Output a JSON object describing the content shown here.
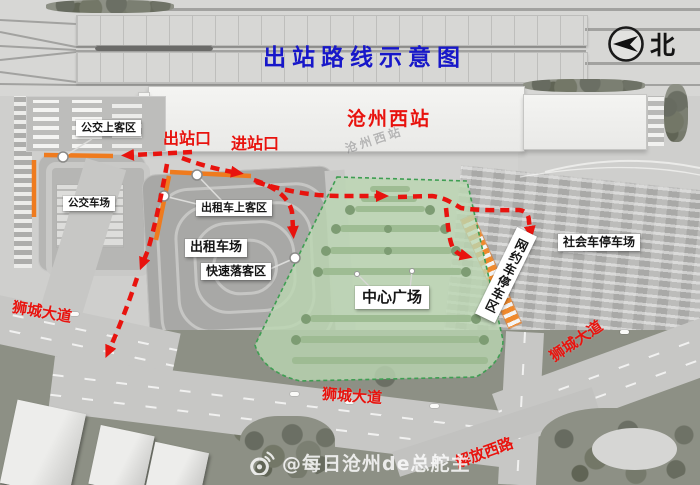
{
  "title": {
    "text": "出站路线示意图",
    "color": "#1717c9"
  },
  "compass": {
    "north_label": "北",
    "icon": "north-arrow-icon"
  },
  "station": {
    "name": "沧州西站",
    "faint_name": "沧州西站"
  },
  "gates": {
    "exit": "出站口",
    "entrance": "进站口"
  },
  "areas": {
    "bus_boarding": "公交上客区",
    "bus_yard": "公交车场",
    "taxi_boarding": "出租车上客区",
    "taxi_yard": "出租车场",
    "quick_dropoff": "快速落客区",
    "central_plaza": "中心广场",
    "ride_hailing_parking": "网约车停车区",
    "public_parking": "社会车停车场"
  },
  "roads": {
    "shicheng_avenue": "狮城大道",
    "jiefang_west_road": "解放西路"
  },
  "legend_colors": {
    "route_red": "#e8130e",
    "pickup_highlight_orange": "#ef7b1e",
    "plaza_green_fill": "#bcd8b4",
    "plaza_green_border": "#3f9e53",
    "title_blue": "#1717c9"
  },
  "watermark": {
    "icon": "weibo-icon",
    "text": "@每日沧州de总舵主"
  }
}
